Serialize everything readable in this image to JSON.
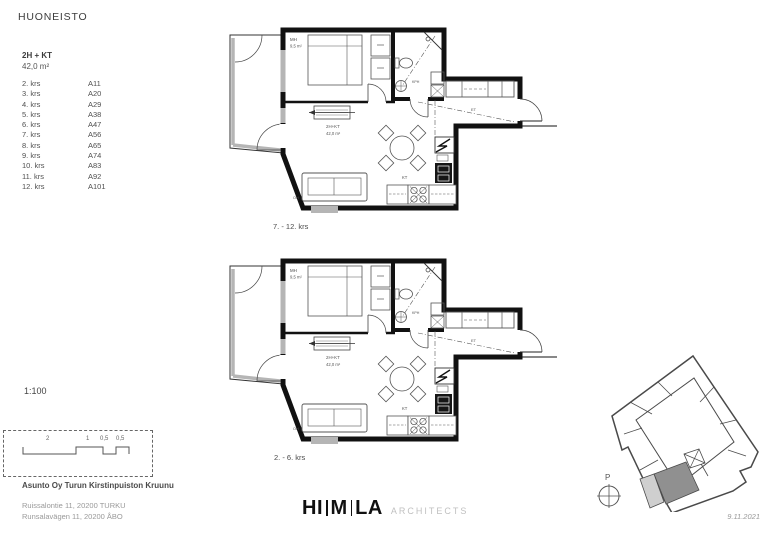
{
  "header": {
    "title": "HUONEISTO"
  },
  "apartment": {
    "type": "2H + KT",
    "area": "42,0 m²"
  },
  "floor_list": [
    {
      "floor": "2. krs",
      "unit": "A11"
    },
    {
      "floor": "3. krs",
      "unit": "A20"
    },
    {
      "floor": "4. krs",
      "unit": "A29"
    },
    {
      "floor": "5. krs",
      "unit": "A38"
    },
    {
      "floor": "6. krs",
      "unit": "A47"
    },
    {
      "floor": "7. krs",
      "unit": "A56"
    },
    {
      "floor": "8. krs",
      "unit": "A65"
    },
    {
      "floor": "9. krs",
      "unit": "A74"
    },
    {
      "floor": "10. krs",
      "unit": "A83"
    },
    {
      "floor": "11. krs",
      "unit": "A92"
    },
    {
      "floor": "12. krs",
      "unit": "A101"
    }
  ],
  "plans": {
    "top_caption": "7. - 12. krs",
    "bottom_caption": "2. - 6. krs",
    "labels": {
      "bedroom": "MH",
      "bedroom_area": "9,5 m²",
      "type": "2H+KT",
      "area": "42,0 m²",
      "bath": "KPH",
      "kitchen": "KT",
      "entry": "ET",
      "living": "OH"
    }
  },
  "scale": {
    "ratio": "1:100",
    "bar_numbers": [
      "2",
      "1",
      "0,5",
      "0,5"
    ]
  },
  "project": {
    "name": "Asunto Oy Turun Kirstinpuiston Kruunu",
    "address_fi": "Ruissalontie 11, 20200 TURKU",
    "address_sv": "Runsalavägen 11, 20200 ÅBO"
  },
  "logo": {
    "part1": "HI",
    "part2": "M",
    "part3": "LA",
    "suffix": "ARCHITECTS"
  },
  "site": {
    "north_label": "P",
    "date": "9.11.2021"
  },
  "colors": {
    "ink": "#111111",
    "window_gray": "#b5b5b5",
    "highlight_dark": "#909090",
    "highlight_light": "#cfcfcf",
    "logo_gray": "#c0c0c0"
  }
}
